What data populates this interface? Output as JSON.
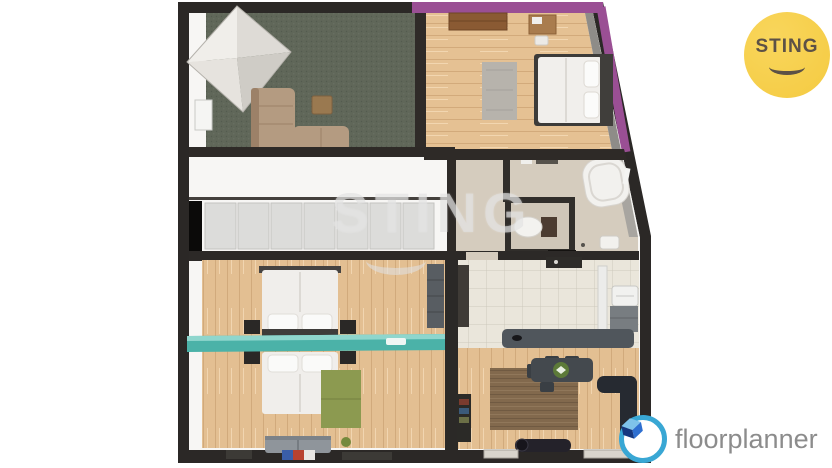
{
  "branding": {
    "sting_badge": {
      "label": "STING",
      "bg_color": "#F4CA41",
      "text_color": "#5C5146"
    },
    "watermark": {
      "label": "STING"
    },
    "floorplanner_logo": {
      "label": "floorplanner",
      "ring_color": "#39A7D4",
      "cube_color": "#1B3F9C",
      "text_color": "#8C8C8C"
    }
  },
  "palette": {
    "wall_dark": "#2B2826",
    "accent_purple": "#9A4F94",
    "teal_partition": "#4BB2A8",
    "wood_floor": "#E5C193",
    "carpet_green": "#606759",
    "tile_beige": "#D5CCBE",
    "kitchen_tile": "#EAE6DB",
    "counter_gray": "#50565C",
    "sofa_tan": "#B49B81",
    "rug_brown": "#82694D",
    "rug_green": "#8C9A50"
  }
}
